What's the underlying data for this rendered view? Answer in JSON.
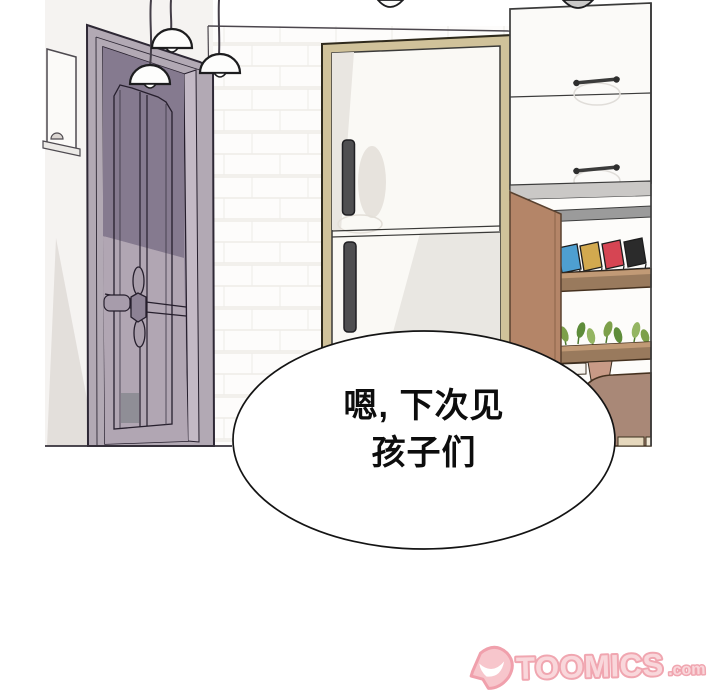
{
  "panel": {
    "speech_bubble": {
      "lines": [
        "嗯, 下次见",
        "孩子们"
      ],
      "fill": "#ffffff",
      "border_color": "#141414",
      "text_color": "#0d0d0d"
    },
    "scene": {
      "wall_color": "#f5f3f1",
      "objects": [
        {
          "name": "purple-door",
          "color": "#998ea0"
        },
        {
          "name": "pendant-lamps",
          "count": 5,
          "color": "#fdfdfc"
        },
        {
          "name": "refrigerator",
          "frame_color": "#d0c29a",
          "door_color": "#faf9f5",
          "handle_color": "#4f4f51"
        },
        {
          "name": "upper-cabinet-drawers",
          "color": "#fbfaf8",
          "handle_color": "#3b3b3b"
        },
        {
          "name": "open-shelf-cabinet",
          "side_color": "#b48568",
          "rail_color": "#9b9b9b"
        },
        {
          "name": "books",
          "colors": [
            "#4e9fd0",
            "#d2a94f",
            "#d64553",
            "#2b2b2b"
          ]
        },
        {
          "name": "plant-shelf",
          "wood_color": "#997a5d",
          "plant_color": "#7da04a"
        },
        {
          "name": "chair",
          "color": "#a98877"
        },
        {
          "name": "wall-frame-shelf",
          "color": "#fbfaf8"
        }
      ]
    }
  },
  "watermark": {
    "brand": "TOOMICS",
    "suffix": ".com",
    "fill_color": "#f9d2d7",
    "outline_color": "#ef9aa6"
  }
}
